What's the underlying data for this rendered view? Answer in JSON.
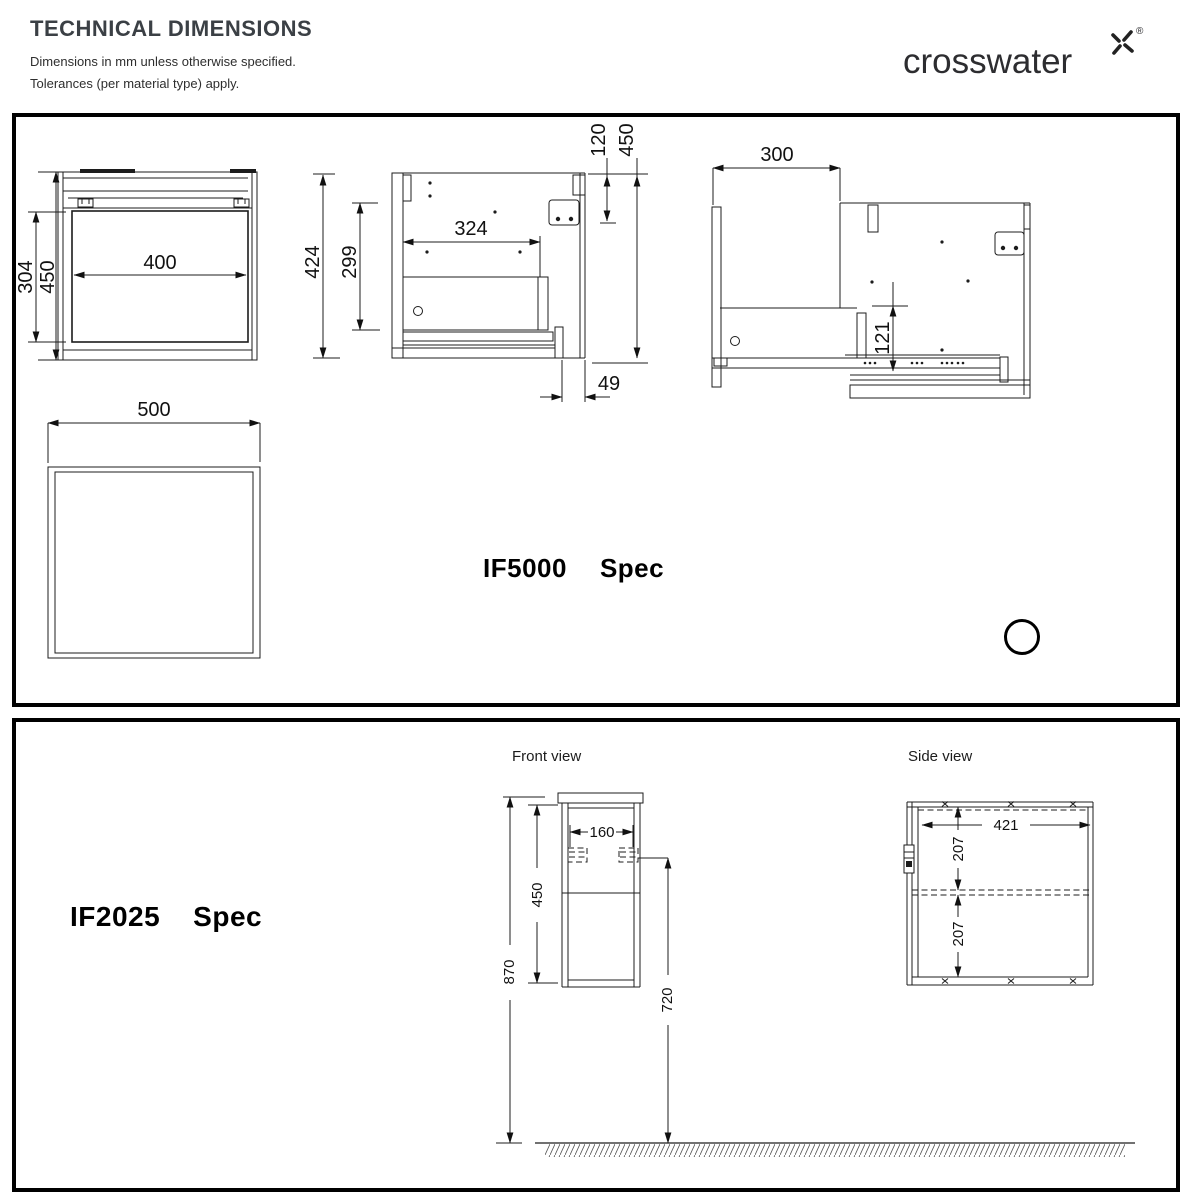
{
  "header": {
    "title": "TECHNICAL DIMENSIONS",
    "note1": "Dimensions in mm unless otherwise specified.",
    "note2": "Tolerances (per material type) apply.",
    "logo_text": "crosswater",
    "logo_reg": "®"
  },
  "if5000": {
    "model": "IF5000",
    "spec": "Spec",
    "front": {
      "opening_width": "400",
      "height": "450",
      "opening_height": "304"
    },
    "side": {
      "height": "424",
      "inner_height": "299",
      "inner_depth": "324",
      "fixing_offset": "120",
      "overall_height": "450",
      "rear_gap": "49"
    },
    "open": {
      "extension": "300",
      "drawer_height": "121"
    },
    "plan": {
      "width": "500"
    }
  },
  "if2025": {
    "model": "IF2025",
    "spec": "Spec",
    "front_label": "Front view",
    "side_label": "Side view",
    "front": {
      "fixing_centres": "160",
      "carcass_height": "450",
      "overall_height": "870",
      "fixing_height": "720"
    },
    "side": {
      "depth": "421",
      "upper_section": "207",
      "lower_section": "207"
    }
  }
}
